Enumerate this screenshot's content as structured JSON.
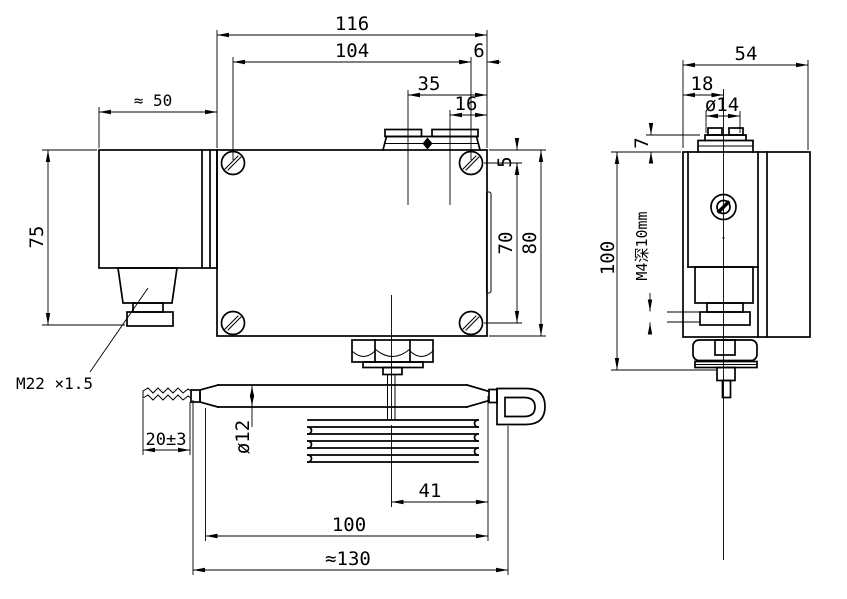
{
  "drawing_title": "Temperature switch dimensional drawing",
  "front": {
    "overall_width": "116",
    "screw_span": "104",
    "screw_edge": "6",
    "pointer_offset": "35",
    "terminal_offset": "16",
    "connector_width": "≈ 50",
    "connector_height": "75",
    "screw_top": "5",
    "screw_span_v": "70",
    "body_height": "80",
    "gland_thread": "M22 ×1.5",
    "flex_tail": "20±3",
    "bulb_dia": "ø12",
    "capillary_offset": "41",
    "bulb_length": "100",
    "overall_length": "≈130"
  },
  "side": {
    "depth": "54",
    "boss_offset": "18",
    "boss_dia": "ø14",
    "boss_height": "7",
    "overall_height": "100",
    "mount_thread": "M4深10mm"
  },
  "colors": {
    "line": "#000000",
    "background": "#ffffff"
  }
}
